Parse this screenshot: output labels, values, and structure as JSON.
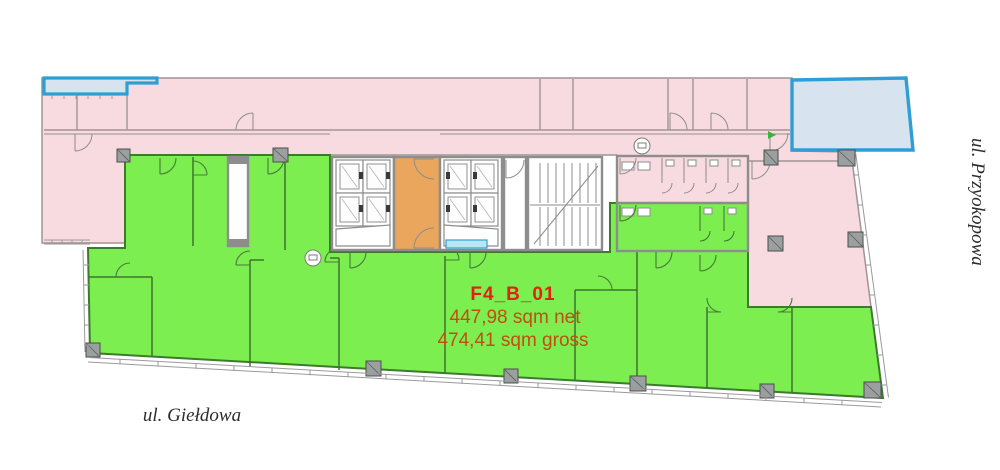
{
  "plan": {
    "unit": {
      "id": "F4_B_01",
      "net_area": "447,98 sqm net",
      "gross_area": "474,41 sqm gross"
    },
    "streets": {
      "bottom": "ul. Giełdowa",
      "right": "ul. Przyokopowa"
    },
    "colors": {
      "unit_available_green": "#7cee4f",
      "common_area_pink": "#f8dbe0",
      "core_lobby_orange": "#e9a65c",
      "terrace_fill_blue": "#d7e3ef",
      "terrace_border_blue": "#2e9fd4",
      "window_blue": "#b9e6f4",
      "unit_label_red": "#e32012",
      "area_text_red": "#c14f10"
    }
  }
}
